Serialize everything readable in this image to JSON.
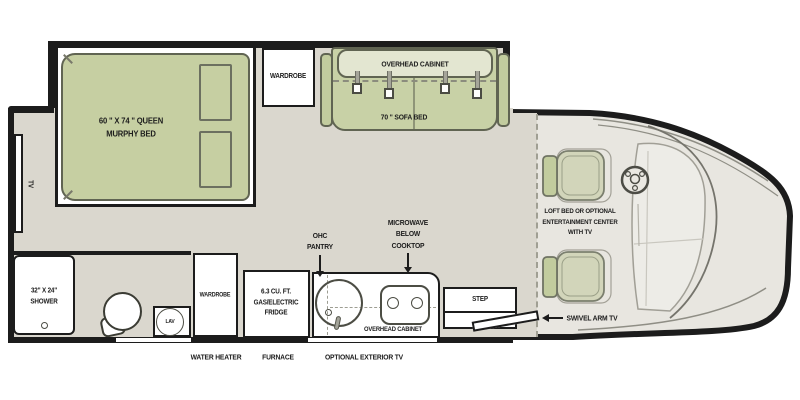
{
  "labels": {
    "murphy_bed": "60 \" X 74 \" QUEEN\nMURPHY BED",
    "wardrobe_top": "WARDROBE",
    "overhead_cabinet_sofa": "OVERHEAD CABINET",
    "sofa_bed": "70 \" SOFA BED",
    "tv": "TV",
    "loft_bed": "LOFT BED OR OPTIONAL\nENTERTAINMENT CENTER\nWITH TV",
    "shower": "32\" X 24\"\nSHOWER",
    "lav": "LAV",
    "wardrobe_bottom": "WARDROBE",
    "fridge": "6.3 CU. FT.\nGAS/ELECTRIC\nFRIDGE",
    "ohc_pantry": "OHC\nPANTRY",
    "microwave": "MICROWAVE\nBELOW\nCOOKTOP",
    "overhead_cabinet_kitchen": "OVERHEAD CABINET",
    "step": "STEP",
    "swivel_arm_tv": "SWIVEL ARM TV",
    "water_heater": "WATER HEATER",
    "furnace": "FURNACE",
    "optional_exterior_tv": "OPTIONAL EXTERIOR TV"
  },
  "colors": {
    "wall": "#1c1c1c",
    "floor": "#dad7ce",
    "cab_floor": "#e8e6e0",
    "bed_green": "#c6cfa2",
    "sofa_green": "#c8d1a6",
    "cabinet_green": "#e3e6d1",
    "seat_green": "#c2cc9e",
    "outline_olive": "#606452"
  }
}
